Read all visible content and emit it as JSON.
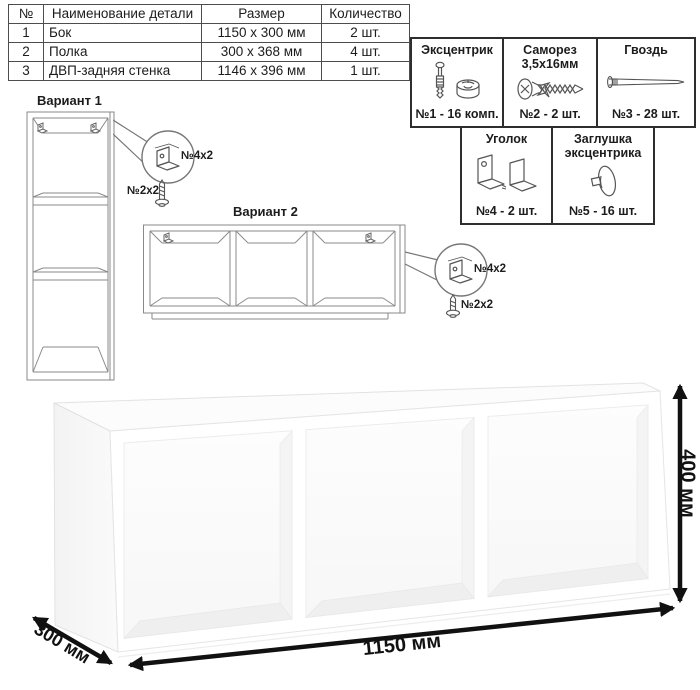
{
  "parts_table": {
    "headers": {
      "num": "№",
      "name": "Наименование детали",
      "size": "Размер",
      "qty": "Количество"
    },
    "rows": [
      {
        "num": "1",
        "name": "Бок",
        "size": "1150 х 300 мм",
        "qty": "2 шт."
      },
      {
        "num": "2",
        "name": "Полка",
        "size": "300 х 368 мм",
        "qty": "4 шт."
      },
      {
        "num": "3",
        "name": "ДВП-задняя стенка",
        "size": "1146 х 396 мм",
        "qty": "1 шт."
      }
    ]
  },
  "hardware": {
    "items": [
      {
        "title": "Эксцентрик",
        "title2": "",
        "count": "№1 - 16 комп.",
        "icon": "cam-lock-icon"
      },
      {
        "title": "Саморез",
        "title2": "3,5х16мм",
        "count": "№2 - 2 шт.",
        "icon": "screw-icon"
      },
      {
        "title": "Гвоздь",
        "title2": "",
        "count": "№3 - 28 шт.",
        "icon": "nail-icon"
      },
      {
        "title": "Уголок",
        "title2": "",
        "count": "№4 - 2 шт.",
        "icon": "angle-bracket-icon"
      },
      {
        "title": "Заглушка",
        "title2": "эксцентрика",
        "count": "№5 - 16 шт.",
        "icon": "cam-cap-icon"
      }
    ]
  },
  "variants": {
    "variant1": {
      "title": "Вариант 1",
      "bracket_label": "№4х2",
      "screw_label": "№2х2"
    },
    "variant2": {
      "title": "Вариант 2",
      "bracket_label": "№4х2",
      "screw_label": "№2х2"
    }
  },
  "dimensions": {
    "width": "1150 мм",
    "depth": "300 мм",
    "height": "400 мм"
  },
  "colors": {
    "line_art": "#8a8a8a",
    "hardware_border": "#2e2e2e",
    "dimension": "#111111"
  }
}
